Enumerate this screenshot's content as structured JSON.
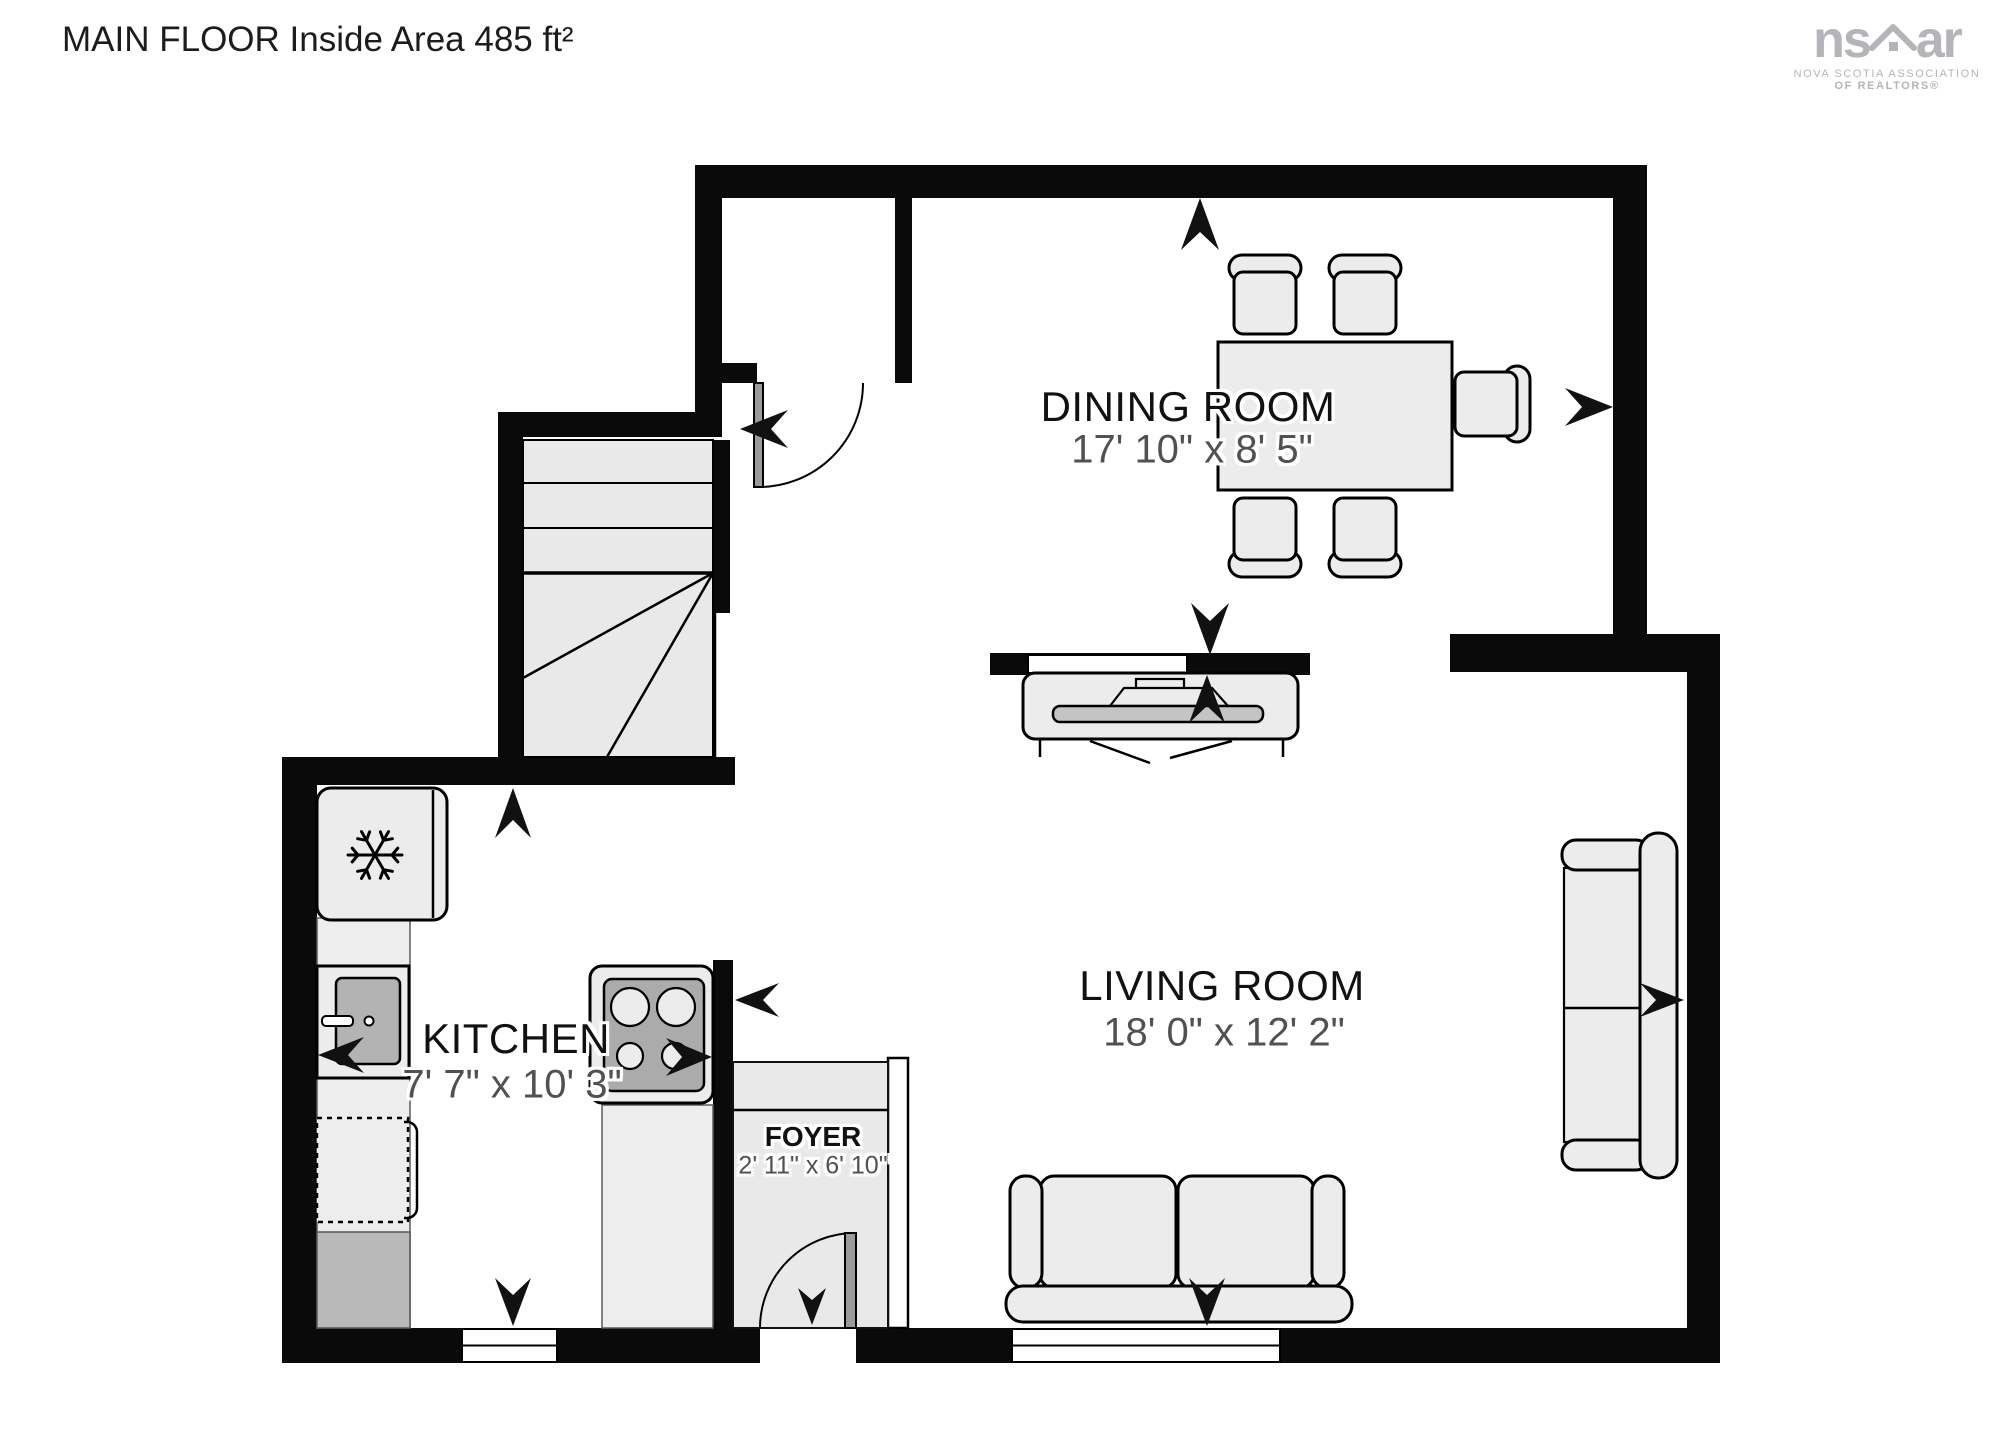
{
  "title": "MAIN FLOOR Inside Area 485 ft²",
  "rooms": {
    "dining": {
      "name": "DINING ROOM",
      "dims": "17' 10\" x 8' 5\""
    },
    "living": {
      "name": "LIVING ROOM",
      "dims": "18' 0\" x 12' 2\""
    },
    "kitchen": {
      "name": "KITCHEN",
      "dims": "7' 7\" x 10' 3\""
    },
    "foyer": {
      "name": "FOYER",
      "dims": "2' 11\" x 6' 10\""
    }
  },
  "logo": {
    "ns": "ns",
    "ar": "ar",
    "line1": "NOVA SCOTIA ASSOCIATION",
    "line2": "OF REALTORS®"
  },
  "icons": {
    "fridge": "snowflake-icon",
    "logo_mark": "house-icon"
  },
  "colors": {
    "wall": "#0a0a0a",
    "furniture_fill": "#ececec",
    "furniture_dark": "#b3b3b3",
    "label": "#111111",
    "dims": "#515151",
    "logo": "#b4b4b9"
  }
}
